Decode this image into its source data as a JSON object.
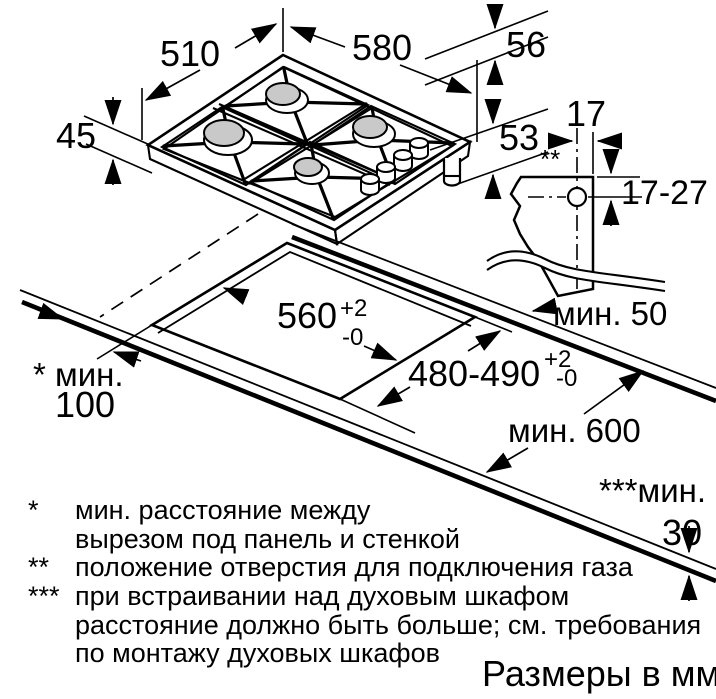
{
  "colors": {
    "line": "#000000",
    "burner_fill": "#c9c9c9",
    "background": "#ffffff"
  },
  "hob_view": {
    "dim_depth": "510",
    "dim_width": "580",
    "dim_height_above": "56",
    "dim_height_rim": "45",
    "dim_height_below": "53"
  },
  "gas_detail": {
    "dim_hole_offset": "17",
    "dim_hole_range": "17-27",
    "hole_marker": "**",
    "min_back": "мин. 50"
  },
  "cutout_view": {
    "dim_width": "560",
    "dim_width_tol_plus": "+2",
    "dim_width_tol_minus": "-0",
    "dim_depth": "480-490",
    "dim_depth_tol_plus": "+2",
    "dim_depth_tol_minus": "-0",
    "min_left_label": "* мин.",
    "min_left_value": "100",
    "min_counter_depth": "мин. 600",
    "min_front_label": "***мин.",
    "min_front_value": "30"
  },
  "footnotes": {
    "f1_symbol": "*",
    "f1_line1": "мин. расстояние между",
    "f1_line2": "вырезом под панель и стенкой",
    "f2_symbol": "**",
    "f2_line1": "положение отверстия для подключения газа",
    "f3_symbol": "***",
    "f3_line1": "при встраивании над духовым шкафом",
    "f3_line2": "расстояние должно быть больше; см. требования",
    "f3_line3": "по монтажу духовых шкафов"
  },
  "caption": "Размеры в мм"
}
